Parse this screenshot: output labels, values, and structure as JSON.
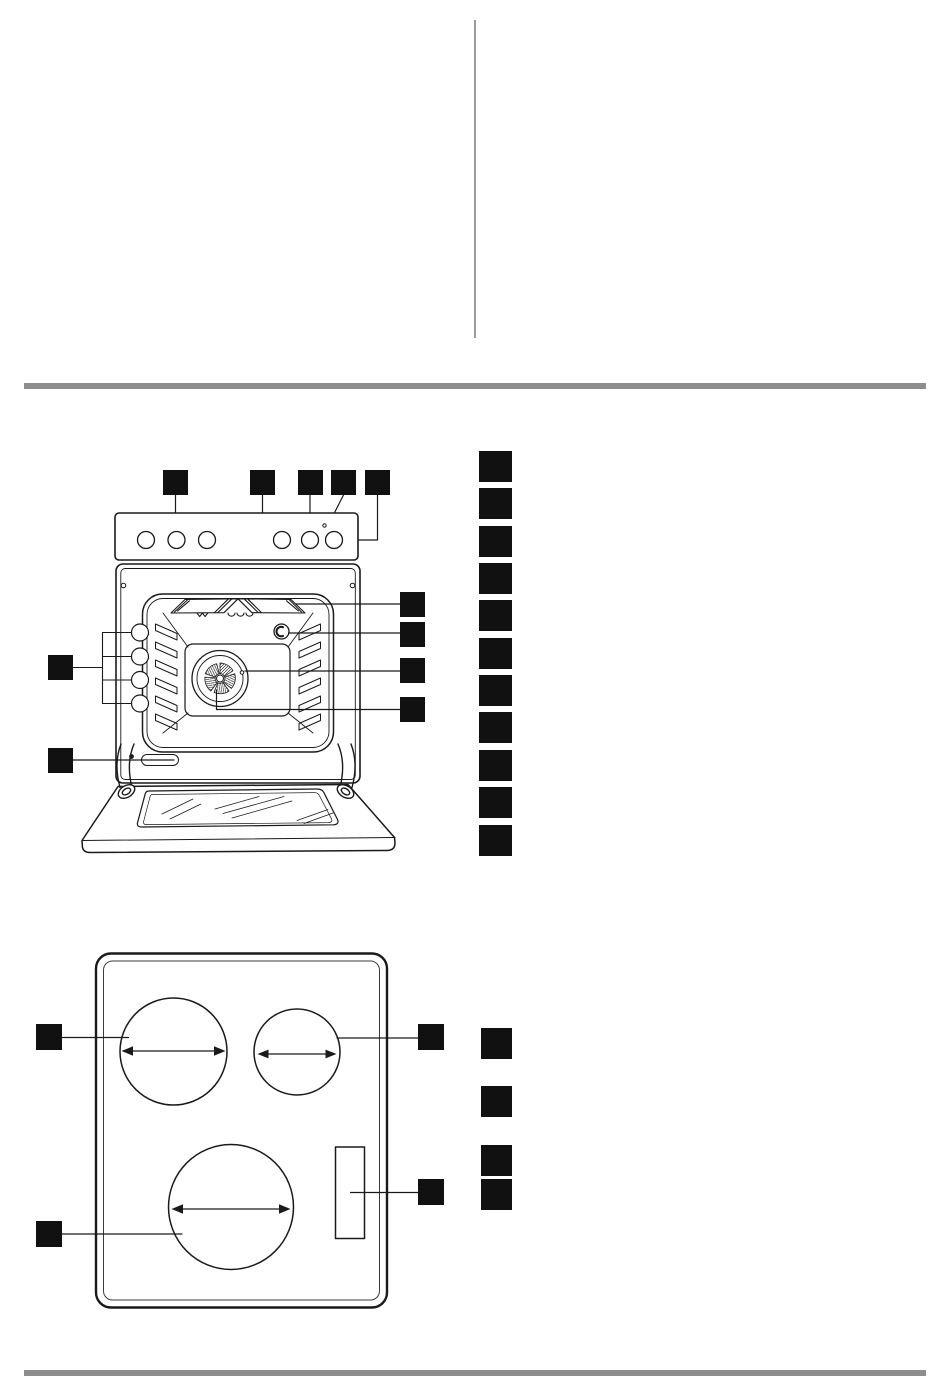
{
  "page": {
    "colors": {
      "bg": "#ffffff",
      "ink": "#111111",
      "rule": "#8d8d8d",
      "divider": "#9a9a9a"
    },
    "visible_text": "",
    "description_of_pixels": "appliance manual page: empty two-column text area above a grey rule, oven front-view line diagram with redacted black number callouts, hob top-view line diagram with redacted black number callouts"
  },
  "oven_figure": {
    "figure": "oven-front-view",
    "callout_boxes": [
      {
        "x": 163,
        "y": 470,
        "w": 25,
        "h": 25
      },
      {
        "x": 250,
        "y": 470,
        "w": 25,
        "h": 25
      },
      {
        "x": 298,
        "y": 470,
        "w": 25,
        "h": 25
      },
      {
        "x": 331,
        "y": 470,
        "w": 25,
        "h": 25
      },
      {
        "x": 365,
        "y": 470,
        "w": 25,
        "h": 25
      },
      {
        "x": 400,
        "y": 592,
        "w": 25,
        "h": 25
      },
      {
        "x": 400,
        "y": 622,
        "w": 25,
        "h": 25
      },
      {
        "x": 400,
        "y": 658,
        "w": 25,
        "h": 25
      },
      {
        "x": 400,
        "y": 697,
        "w": 25,
        "h": 25
      },
      {
        "x": 48,
        "y": 655,
        "w": 25,
        "h": 25
      },
      {
        "x": 48,
        "y": 748,
        "w": 25,
        "h": 25
      }
    ],
    "legend_boxes": [
      {
        "x": 479,
        "y": 451,
        "w": 33,
        "h": 31
      },
      {
        "x": 479,
        "y": 488,
        "w": 33,
        "h": 31
      },
      {
        "x": 479,
        "y": 526,
        "w": 33,
        "h": 31
      },
      {
        "x": 479,
        "y": 563,
        "w": 33,
        "h": 31
      },
      {
        "x": 479,
        "y": 600,
        "w": 33,
        "h": 31
      },
      {
        "x": 479,
        "y": 638,
        "w": 33,
        "h": 31
      },
      {
        "x": 479,
        "y": 675,
        "w": 33,
        "h": 31
      },
      {
        "x": 479,
        "y": 712,
        "w": 33,
        "h": 31
      },
      {
        "x": 479,
        "y": 750,
        "w": 33,
        "h": 31
      },
      {
        "x": 479,
        "y": 787,
        "w": 33,
        "h": 31
      },
      {
        "x": 479,
        "y": 825,
        "w": 33,
        "h": 31
      }
    ]
  },
  "hob_figure": {
    "figure": "hob-top-view",
    "callout_boxes": [
      {
        "x": 36,
        "y": 1024,
        "w": 26,
        "h": 26
      },
      {
        "x": 418,
        "y": 1024,
        "w": 26,
        "h": 26
      },
      {
        "x": 36,
        "y": 1221,
        "w": 26,
        "h": 26
      },
      {
        "x": 418,
        "y": 1179,
        "w": 26,
        "h": 26
      }
    ],
    "legend_boxes": [
      {
        "x": 481,
        "y": 1028,
        "w": 31,
        "h": 31
      },
      {
        "x": 481,
        "y": 1086,
        "w": 31,
        "h": 31
      },
      {
        "x": 481,
        "y": 1145,
        "w": 31,
        "h": 31
      },
      {
        "x": 481,
        "y": 1179,
        "w": 31,
        "h": 31
      }
    ]
  }
}
